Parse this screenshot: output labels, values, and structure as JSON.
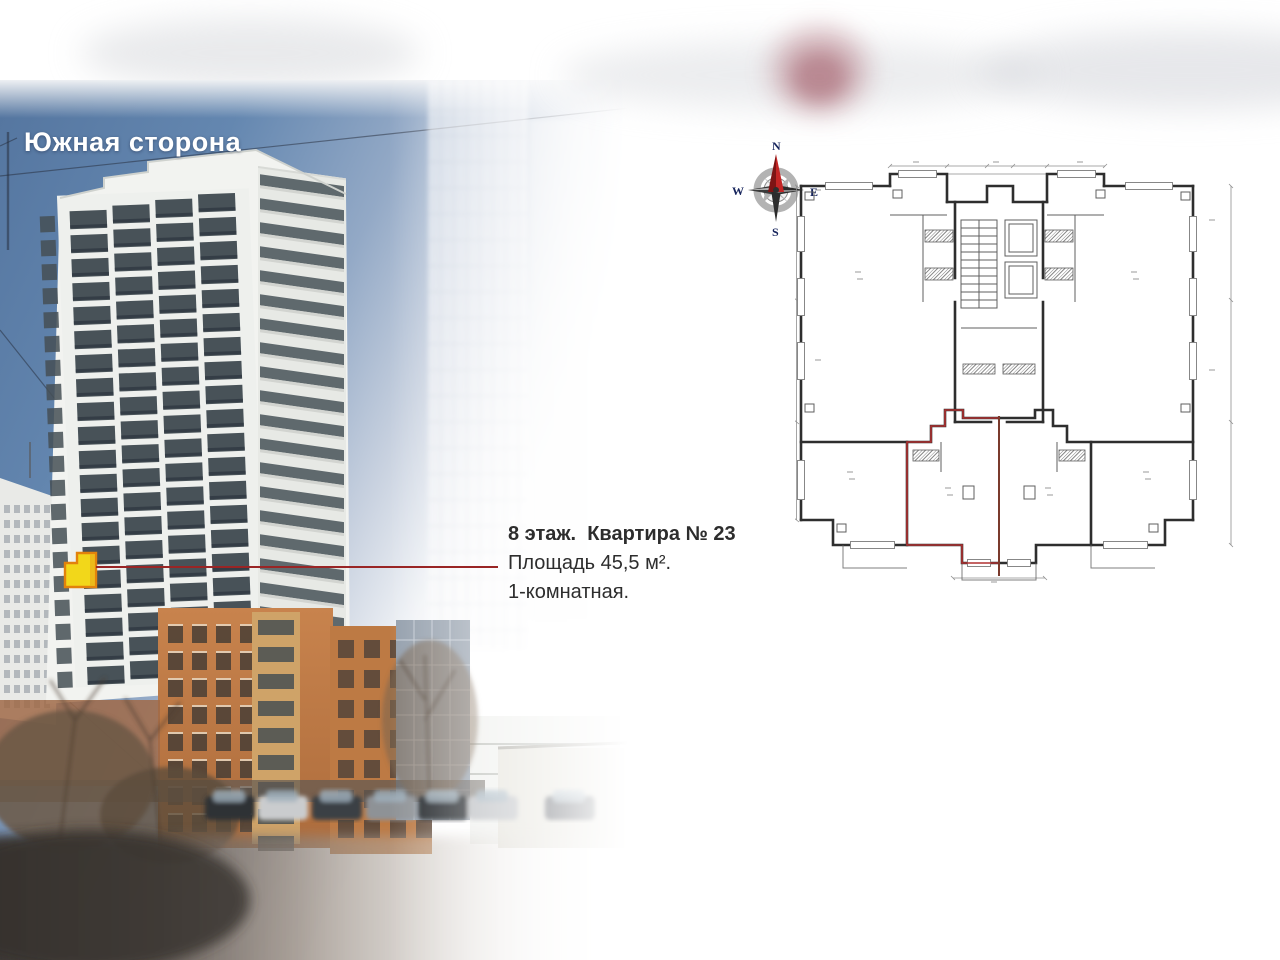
{
  "slide": {
    "title": "Южная сторона",
    "callout": {
      "line1": "8 этаж.  Квартира № 23",
      "line2": "Площадь 45,5 м².",
      "line3": "1-комнатная."
    },
    "compass": {
      "north": "N",
      "south": "S",
      "east": "E",
      "west": "W"
    },
    "highlight": {
      "marker_fill": "#f2d71a",
      "marker_border": "#e2820c",
      "leader_color": "#992525",
      "apartment_outline": "#b03030"
    }
  }
}
